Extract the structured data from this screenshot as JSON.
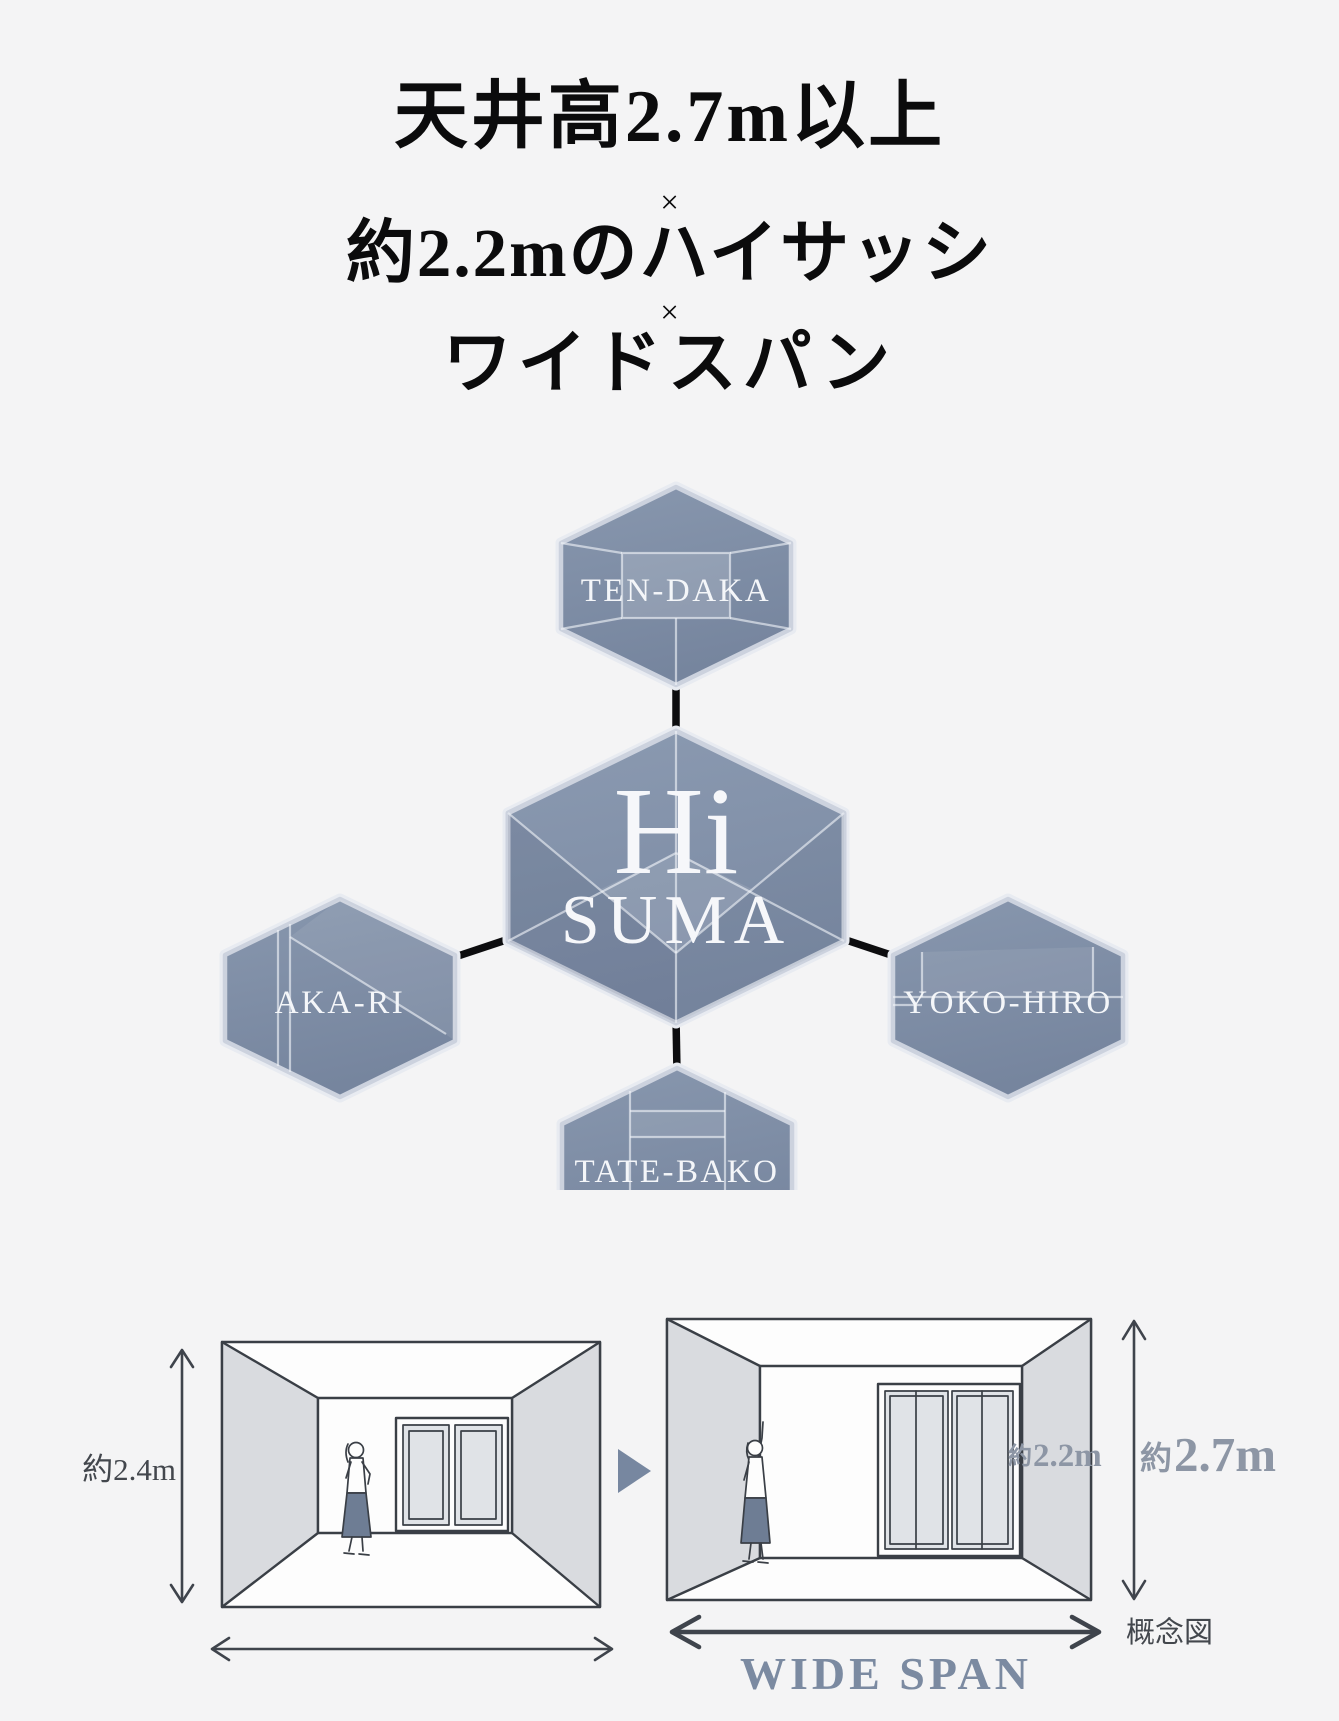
{
  "title": {
    "line1": "天井高2.7m以上",
    "separator1": "×",
    "line2": "約2.2mのハイサッシ",
    "separator2": "×",
    "line3": "ワイドスパン"
  },
  "diagram": {
    "center_title": "Hi",
    "center_subtitle": "SUMA",
    "node_top": "TEN-DAKA",
    "node_left": "AKA-RI",
    "node_right": "YOKO-HIRO",
    "node_bottom": "TATE-BAKO"
  },
  "comparison": {
    "before_ceiling_height": "約2.4m",
    "after_sash_prefix": "約",
    "after_sash_value": "2.2m",
    "after_ceiling_prefix": "約",
    "after_ceiling_value": "2.7m",
    "span_label": "WIDE SPAN",
    "note": "概念図"
  },
  "colors": {
    "background": "#f4f4f5",
    "hexagon_slate": "#7e8ca4",
    "hexagon_border": "#ccd2de",
    "connector_black": "#0d0d0f",
    "measure_gray_blue": "#8d96a5",
    "wide_span_blue": "#7b8aa1",
    "wall_gray": "#d9dbdf",
    "skirt_slate": "#6e7d94"
  }
}
